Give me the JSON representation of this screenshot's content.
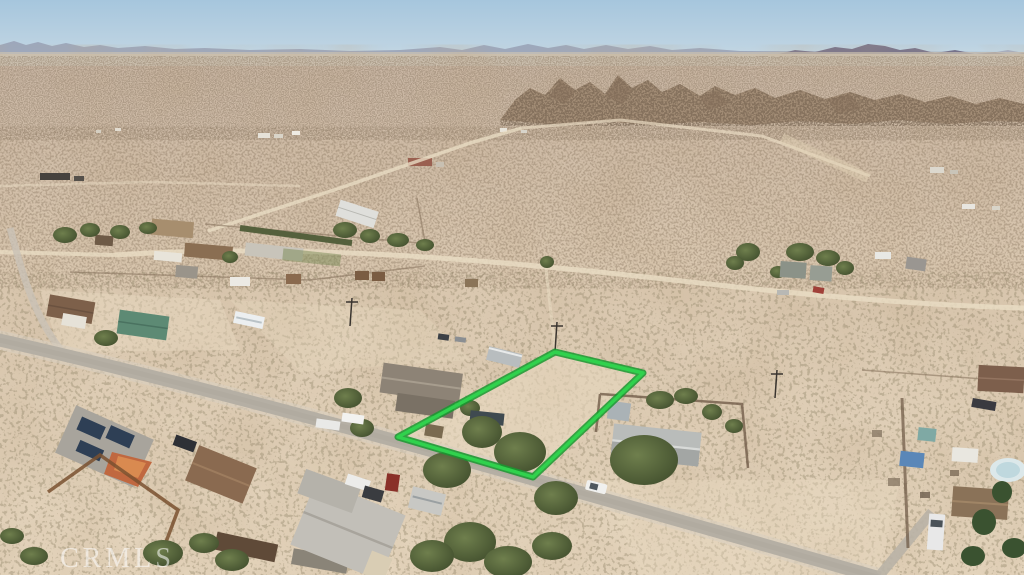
{
  "watermark": {
    "text": "CRMLS"
  },
  "lot_boundary": {
    "label": "outlined-vacant-lot",
    "stroke_color": "#30d24d",
    "casing_color": "#17992f",
    "points": "555,352 643,373 533,477 398,437"
  },
  "palette": {
    "sky_top": "#a6c6dd",
    "sky_horizon": "#cadbe4",
    "mountains_far": "#98a0b4",
    "mountains_near": "#76728a",
    "rocky_hills": "#a28c75",
    "desert_far": "#c7b4a2",
    "desert_near": "#e4d4bc",
    "paved_road": "#b5afa4",
    "dirt_road": "#e9dcc3",
    "vegetation": "#4e5c36"
  },
  "scene": {
    "type": "aerial-photo",
    "description": "Aerial drone view of a desert neighborhood with scattered homes, dirt tracks, scrub vegetation, a diagonal paved road, rocky hills and distant mountains under a clear sky; a vacant rectangular lot beside the road is outlined in green.",
    "landmarks": [
      "distant mountain range on horizon",
      "rocky hills upper right",
      "fenced ranch compound upper left",
      "green-outlined vacant lot at center",
      "gray-roof house right of the lot",
      "house with rooftop solar panels lower left",
      "paved road crossing diagonally",
      "white car on road",
      "CRMLS watermark lower left"
    ]
  }
}
